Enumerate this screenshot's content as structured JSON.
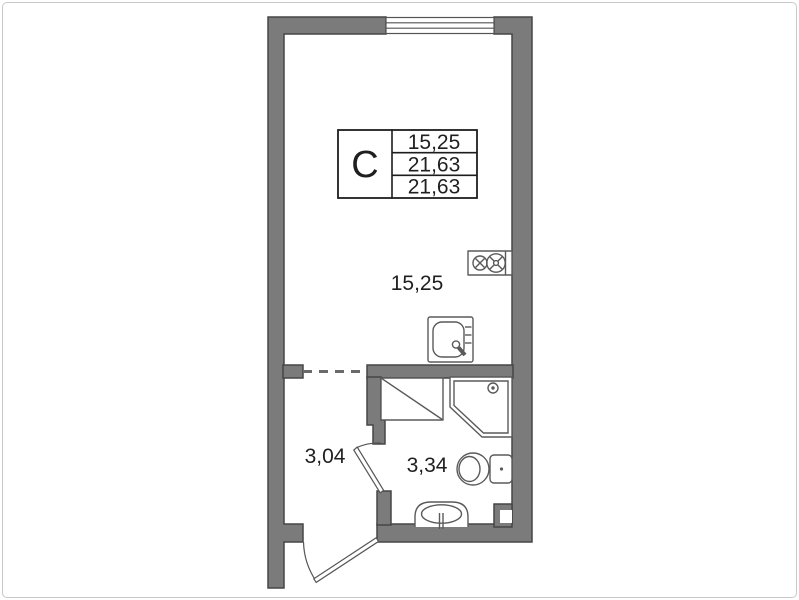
{
  "stamp": {
    "type_label": "С",
    "rows": [
      "15,25",
      "21,63",
      "21,63"
    ]
  },
  "rooms": [
    {
      "name": "living-room",
      "area_label": "15,25"
    },
    {
      "name": "hallway",
      "area_label": "3,04"
    },
    {
      "name": "bathroom",
      "area_label": "3,34"
    }
  ],
  "icons": [
    "window-icon",
    "stove-icon",
    "kitchen-sink-icon",
    "shower-tray-icon",
    "toilet-icon",
    "washbasin-icon",
    "vent-shaft-icon",
    "entrance-door-icon",
    "bathroom-door-icon"
  ],
  "colors": {
    "wall": "#7b7b7b",
    "wall_outline": "#464646",
    "fixture_line": "#5a5a5a",
    "text": "#1f1f1f",
    "background": "#ffffff",
    "frame": "#c9c9c9"
  }
}
